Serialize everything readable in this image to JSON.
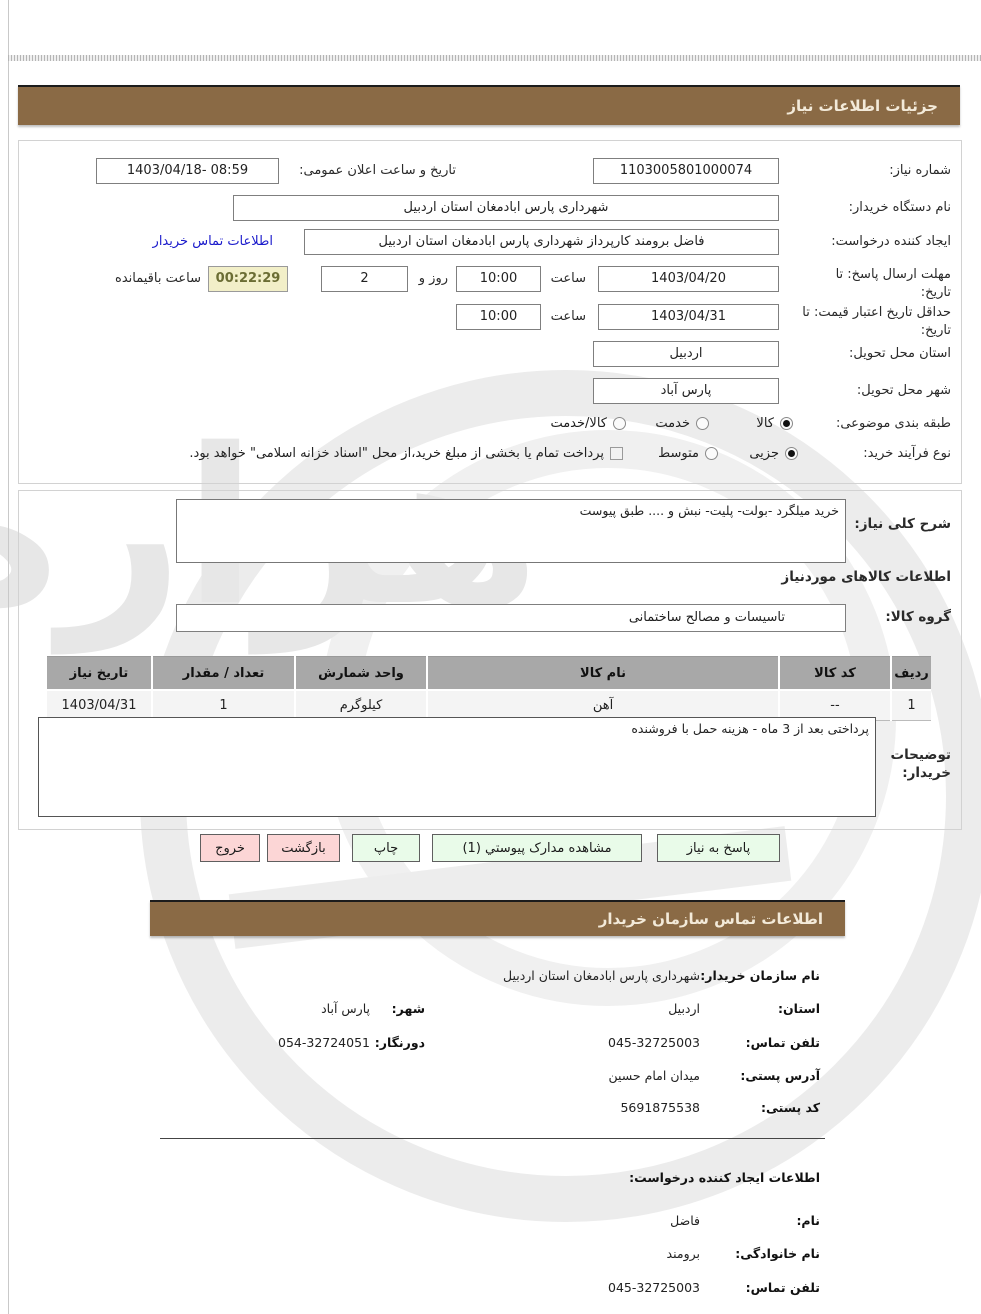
{
  "page": {
    "title_bar1": "جزئیات اطلاعات نیاز",
    "title_bar2": "اطلاعات تماس سازمان خریدار"
  },
  "colors": {
    "accent_brown": "#8a6a45",
    "button_green": "#e9fbe9",
    "button_pink": "#fcd6d6",
    "link_blue": "#1a1acb",
    "remaining_bg": "#f2efc8",
    "remaining_text": "#6b6d34",
    "table_header_bg": "#a8a8a8"
  },
  "fields": {
    "need_number": {
      "label": "شماره نیاز:",
      "value": "1103005801000074"
    },
    "announce_datetime": {
      "label": "تاریخ و ساعت اعلان عمومی:",
      "value": "1403/04/18- 08:59"
    },
    "buyer_org_name": {
      "label": "نام دستگاه خریدار:",
      "value": "شهرداری پارس ابادمغان استان اردبیل"
    },
    "request_creator": {
      "label": "ایجاد کننده درخواست:",
      "value": "فاضل برومند کارپرداز شهرداری پارس ابادمغان استان اردبیل",
      "link": "اطلاعات تماس خریدار"
    },
    "reply_deadline": {
      "label": "مهلت ارسال پاسخ: تا تاریخ:",
      "date": "1403/04/20",
      "hour_label": "ساعت",
      "time": "10:00",
      "days_label": "روز و",
      "days": "2",
      "remaining": "00:22:29",
      "remaining_label": "ساعت باقیمانده"
    },
    "price_validity": {
      "label": "حداقل تاریخ اعتبار قیمت: تا تاریخ:",
      "date": "1403/04/31",
      "hour_label": "ساعت",
      "time": "10:00"
    },
    "delivery_province": {
      "label": "استان محل تحویل:",
      "value": "اردبیل"
    },
    "delivery_city": {
      "label": "شهر محل تحویل:",
      "value": "پارس آباد"
    },
    "classification": {
      "label": "طبقه بندی موضوعی:",
      "options": [
        "کالا",
        "خدمت",
        "کالا/خدمت"
      ],
      "selected": 0
    },
    "purchase_process": {
      "label": "نوع فرآیند خرید:",
      "options": [
        "جزیی",
        "متوسط"
      ],
      "selected": 0,
      "checkbox_label": "پرداخت تمام یا بخشی از مبلغ خرید،از محل \"اسناد خزانه اسلامی\" خواهد بود."
    },
    "need_description": {
      "label": "شرح کلی نیاز:",
      "value": "خرید میلگرد -بولت- پلیت- نبش و .... طبق پیوست"
    },
    "goods_info_heading": "اطلاعات کالاهای موردنیاز",
    "goods_group": {
      "label": "گروه کالا:",
      "value": "تاسیسات و مصالح ساختمانی"
    },
    "buyer_notes": {
      "label": "توضیحات خریدار:",
      "value": "پرداختی بعد از 3 ماه - هزینه حمل با فروشنده"
    }
  },
  "table": {
    "headers": [
      "ردیف",
      "کد کالا",
      "نام کالا",
      "واحد شمارش",
      "تعداد / مقدار",
      "تاریخ نیاز"
    ],
    "rows": [
      [
        "1",
        "--",
        "آهن",
        "کیلوگرم",
        "1",
        "1403/04/31"
      ]
    ]
  },
  "buttons": {
    "reply": "پاسخ به نیاز",
    "view_docs": "مشاهده مدارک پیوستي (1)",
    "print": "چاپ",
    "back": "بازگشت",
    "exit": "خروج"
  },
  "contact": {
    "org_name": {
      "label": "نام سازمان خریدار:",
      "value": "شهرداری پارس ابادمغان استان اردبیل"
    },
    "province": {
      "label": "استان:",
      "value": "اردبیل"
    },
    "city": {
      "label": "شهر:",
      "value": "پارس آباد"
    },
    "phone": {
      "label": "تلفن تماس:",
      "value": "045-32725003"
    },
    "fax": {
      "label": "دورنگار:",
      "value": "054-32724051"
    },
    "postal_address": {
      "label": "آدرس پستی:",
      "value": "میدان امام حسین"
    },
    "postal_code": {
      "label": "کد پستی:",
      "value": "5691875538"
    },
    "creator_heading": "اطلاعات ایجاد کننده درخواست:",
    "first_name": {
      "label": "نام:",
      "value": "فاضل"
    },
    "last_name": {
      "label": "نام خانوادگی:",
      "value": "برومند"
    },
    "creator_phone": {
      "label": "تلفن تماس:",
      "value": "045-32725003"
    }
  }
}
